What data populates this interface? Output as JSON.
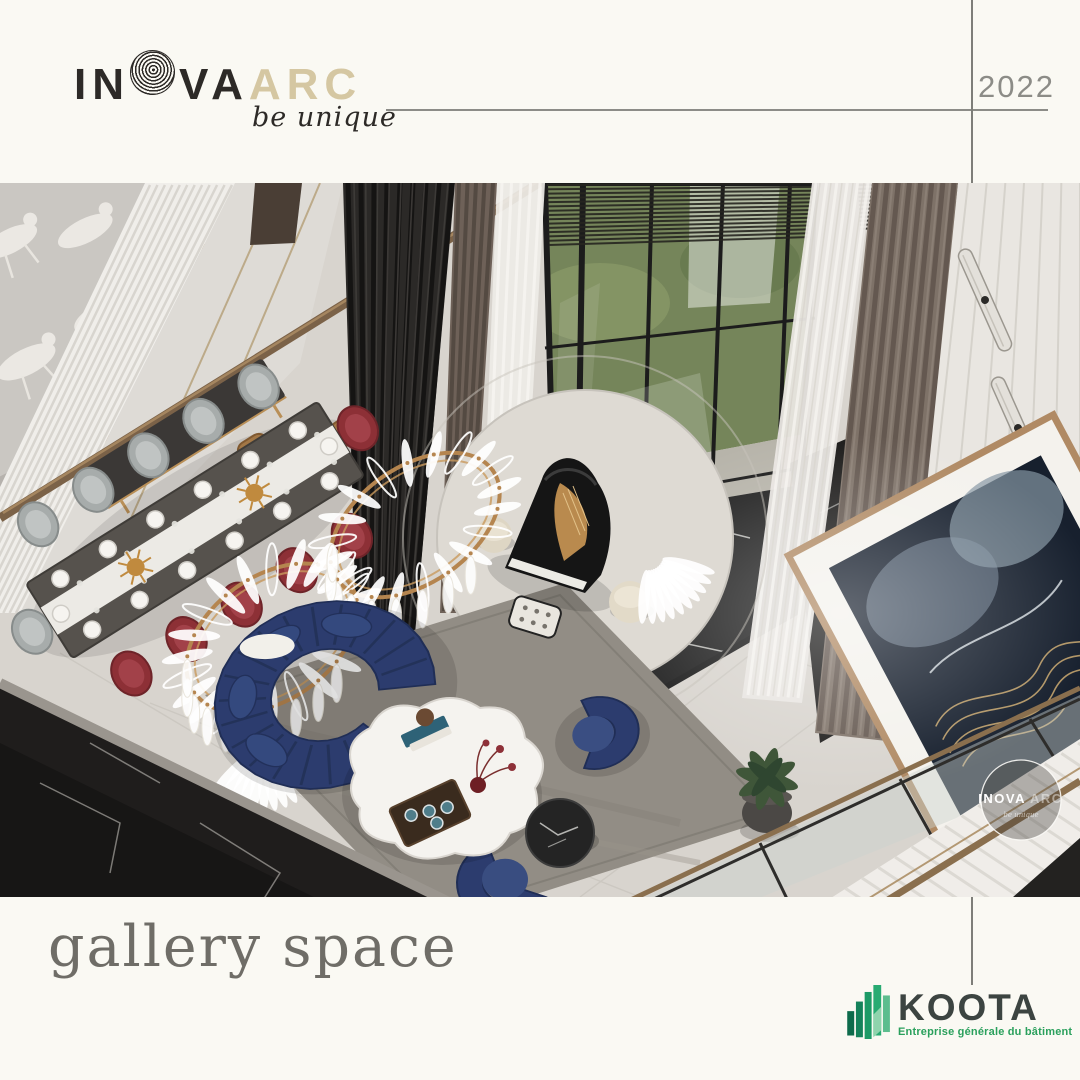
{
  "page": {
    "background_color": "#faf9f3"
  },
  "header": {
    "logo": {
      "part1": "IN",
      "part2": "VA",
      "part3": "ARC",
      "fingerprint_icon": "fingerprint-o",
      "tagline": "be unique"
    },
    "year": "2022"
  },
  "photo": {
    "watermark": {
      "name": "INOVA",
      "suffix": "ARC",
      "tagline": "be unique"
    }
  },
  "footer": {
    "caption": "gallery space",
    "partner": {
      "name": "KOOTA",
      "tagline": "Entreprise générale du bâtiment"
    }
  },
  "colors": {
    "accent_beige": "#d5c7a2",
    "logo_dark": "#2d2a27",
    "line_gray": "#8c8c87",
    "caption_gray": "#6f6d67",
    "koota_dark": "#3c4441",
    "koota_green": "#2aa05c"
  }
}
